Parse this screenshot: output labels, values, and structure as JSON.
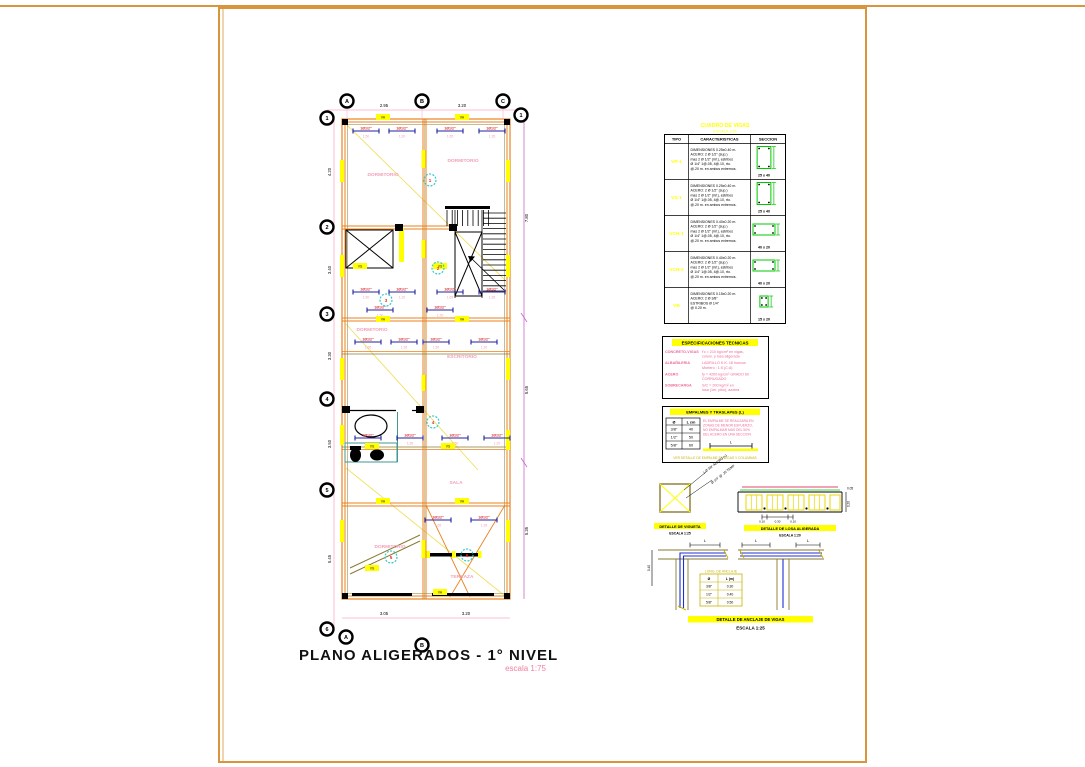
{
  "sheet": {
    "title": "PLANO ALIGERADOS - 1° NIVEL",
    "scale_label": "escala 1:75"
  },
  "colors": {
    "frame_orange": "#D9953B",
    "wall_orange": "#E8821E",
    "highlight_yellow": "#FFFF00",
    "room_pink": "#F2A0B6",
    "rebar_red": "#E03030",
    "spec_magenta": "#F06898",
    "dim_pink": "#FFAACC",
    "dim_violet": "#CC66CC",
    "mark_cyan": "#30C8C8",
    "bar_navy": "#2020A0",
    "detail_blue": "#2030D0",
    "section_green": "#00C800",
    "fixture_teal": "#409890",
    "beam_olive": "#8A7A30"
  },
  "plan": {
    "grid_top": [
      "A",
      "B",
      "C"
    ],
    "grid_left": [
      "1",
      "2",
      "3",
      "4",
      "5",
      "6"
    ],
    "grid_right_first": "1",
    "grid_bottom": [
      "A",
      "B"
    ],
    "dims_top": [
      "2.95",
      "3.20"
    ],
    "dims_left": [
      "4.20",
      "3.40",
      "3.30",
      "3.50",
      "5.45"
    ],
    "dims_right": [
      "7.80",
      "5.65",
      "5.35"
    ],
    "dims_bottom": [
      "3.05",
      "3.20"
    ],
    "rooms": [
      "DORMITORIO",
      "DORMITORIO",
      "DORMITORIO",
      "ESCRITORIO",
      "SALA",
      "DORMITORIO",
      "TERRAZA"
    ],
    "circle_marks": [
      "1",
      "2",
      "3",
      "4",
      "5",
      "6"
    ],
    "rebar_label": "1Ø1/2\"",
    "rebar_lengths": [
      "1.50",
      "1.20",
      "1.65",
      "1.35"
    ],
    "beam_tags": [
      "VA",
      "VA",
      "VS",
      "VS",
      "VA",
      "VA",
      "VS",
      "VS",
      "VA",
      "VA",
      "VS",
      "VA"
    ]
  },
  "beam_table": {
    "title": "CUADRO DE VIGAS",
    "subtitle": "ESCALA 1:25",
    "headers": [
      "TIPO",
      "CARACTERISTICAS",
      "SECCION"
    ],
    "rows": [
      {
        "type": "VP-1",
        "desc": [
          "DIMENSIONES 0.25x0.40 m.",
          "ACERO: 2 Ø 1/2\" (sup.)",
          "mas 2 Ø 1/2\" (inf.), estribos",
          "Ø 1/4\" 1@.05, 4@.10, rto.",
          "@.20 m. en ambos extremos."
        ],
        "dim": "25 x 40"
      },
      {
        "type": "VS-1",
        "desc": [
          "DIMENSIONES 0.25x0.40 m.",
          "ACERO: 2 Ø 1/2\" (sup.)",
          "mas 2 Ø 1/2\" (inf.), estribos",
          "Ø 1/4\" 1@.05, 4@.10, rto.",
          "@.20 m. en ambos extremos."
        ],
        "dim": "25 x 40"
      },
      {
        "type": "VCH-1",
        "desc": [
          "DIMENSIONES 0.40x0.20 m.",
          "ACERO: 2 Ø 1/2\" (sup.)",
          "mas 2 Ø 1/2\" (inf.), estribos",
          "Ø 1/4\" 1@.05, 4@.10, rto.",
          "@.20 m. en ambos extremos."
        ],
        "dim": "40 x 20"
      },
      {
        "type": "VCH-2",
        "desc": [
          "DIMENSIONES 0.40x0.20 m.",
          "ACERO: 2 Ø 1/2\" (sup.)",
          "mas 2 Ø 1/2\" (inf.), estribos",
          "Ø 1/4\" 1@.05, 4@.10, rto.",
          "@.20 m. en ambos extremos."
        ],
        "dim": "40 x 20"
      },
      {
        "type": "VB",
        "desc": [
          "DIMENSIONES 0.15x0.20 m.",
          "ACERO: 2 Ø 3/8\"",
          "ESTRIBOS Ø 1/4\"",
          "@ 0.20 m."
        ],
        "dim": "15 x 20"
      }
    ]
  },
  "specs": {
    "title": "ESPECIFICACIONES TECNICAS",
    "items": [
      {
        "label": "CONCRETO-VIGAS",
        "lines": [
          "f'c = 210 kg/cm² en vigas,",
          "colum. y losa aligerada"
        ]
      },
      {
        "label": "ALBAÑILERIA",
        "lines": [
          "LADRILLO K.K. 18 huecos",
          "Mortero  :  1:5 (C:A)"
        ]
      },
      {
        "label": "ACERO",
        "lines": [
          "fy = 4200 kg/cm² GRADO 60",
          "CORRUGADO"
        ]
      },
      {
        "label": "SOBRECARGA",
        "lines": [
          "S/C = 200 kg/m² en",
          "losa (1er. piso),  azotea"
        ]
      }
    ]
  },
  "splice_table": {
    "title": "EMPALMES Y TRASLAPES (L)",
    "col1": "Ø",
    "col2": "L cm",
    "rows": [
      [
        "3/8\"",
        "40"
      ],
      [
        "1/2\"",
        "50"
      ],
      [
        "5/8\"",
        "60"
      ]
    ],
    "note": [
      "EL EMPALME SE REALIZARA EN",
      "ZONAS DE MENOR ESFUERZO,",
      "NO EMPALMAR MAS DEL 50%",
      "DEL ACERO EN UNA SECCION"
    ],
    "dim_label": "L",
    "footer": "VER DETALLE DE EMPALME EN VIGAS Y COLUMNAS"
  },
  "details": {
    "vigueta": {
      "title": "DETALLE DE VIGUETA",
      "scale": "ESCALA 1:25",
      "note1": "1 Ø 3/8\" ACERO (+)",
      "note2": "Ø 1/4\" @ .25 TEMP."
    },
    "losa": {
      "title": "DETALLE DE LOSA ALIGERADA",
      "scale": "ESCALA 1:20",
      "dims": [
        "0.10",
        "0.30",
        "0.10"
      ],
      "height": "0.20",
      "top": "0.05"
    },
    "anchor": {
      "title": "DETALLE DE ANCLAJE DE VIGAS",
      "scale": "ESCALA 1:25",
      "dim_label": "L",
      "side_dim": "0.40",
      "table_title": "LONG. DE ANCLAJE",
      "table_headers": [
        "Ø",
        "L (m)"
      ],
      "table_rows": [
        [
          "3/8\"",
          "0.30"
        ],
        [
          "1/2\"",
          "0.40"
        ],
        [
          "5/8\"",
          "0.50"
        ]
      ]
    }
  }
}
